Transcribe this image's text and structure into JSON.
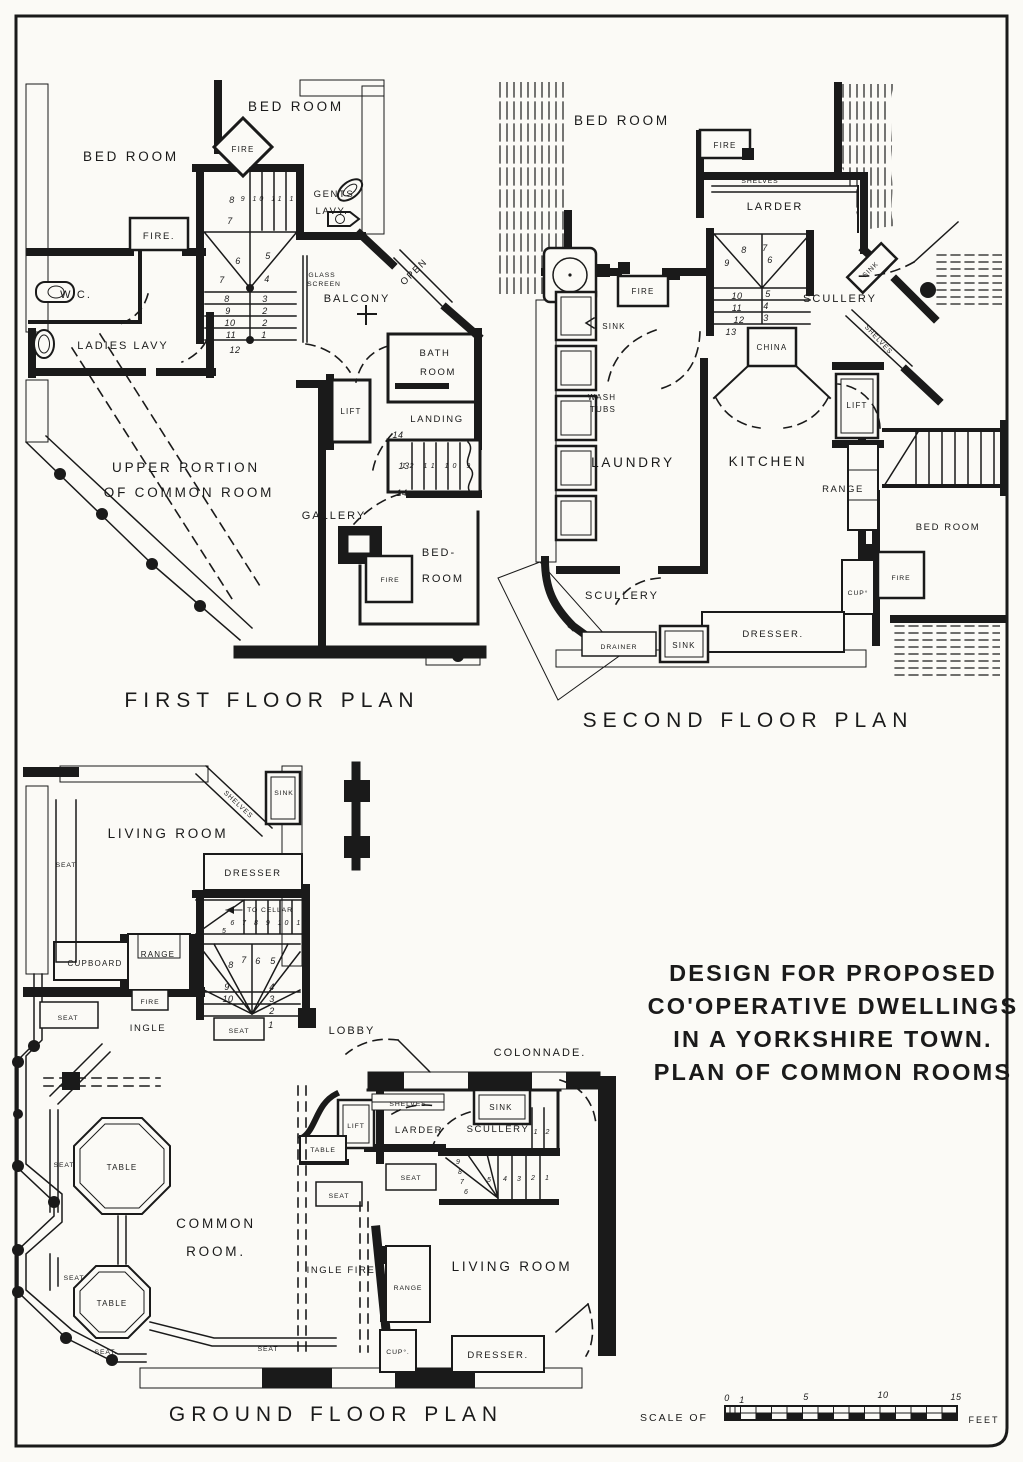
{
  "sheet": {
    "background": "#fbfaf6",
    "ink": "#1a1a1a"
  },
  "title_block": {
    "l1": "DESIGN FOR PROPOSED",
    "l2": "CO'OPERATIVE DWELLINGS",
    "l3": "IN A YORKSHIRE TOWN.",
    "l4": "PLAN OF COMMON ROOMS"
  },
  "scale_bar": {
    "prefix": "SCALE OF",
    "suffix": "FEET",
    "t0": "0",
    "t1": "1",
    "t5": "5",
    "t10": "10",
    "t15": "15"
  },
  "first_floor": {
    "caption": "FIRST FLOOR PLAN",
    "labels": {
      "bed_room_top": "BED ROOM",
      "bed_room_left": "BED ROOM",
      "fire_diamond": "FIRE",
      "gents_1": "GENTS",
      "gents_2": "LAVY.",
      "fire_left": "FIRE.",
      "wc": "W.C.",
      "ladies_lavy": "LADIES LAVY",
      "balcony": "BALCONY",
      "open": "OPEN",
      "glass_1": "GLASS",
      "glass_2": "SCREEN",
      "bath_1": "BATH",
      "bath_2": "ROOM",
      "lift": "LIFT",
      "landing": "LANDING",
      "gallery": "GALLERY",
      "upper_1": "UPPER PORTION",
      "upper_2": "OF COMMON ROOM",
      "bed_1": "BED-",
      "bed_2": "ROOM",
      "fire_small": "FIRE"
    },
    "numbers": {
      "n8": "8",
      "run_up": "9 10 11 12",
      "n7a": "7",
      "n6": "6",
      "n5": "5",
      "n7b": "7",
      "n4": "4",
      "r8": "8",
      "r3": "3",
      "r9": "9",
      "r2a": "2",
      "r10": "10",
      "r2b": "2",
      "r11": "11",
      "r1": "1",
      "r12": "12",
      "l14a": "14",
      "l13": "13",
      "l_run": "12 11 10 9",
      "l14b": "14"
    }
  },
  "second_floor": {
    "caption": "SECOND FLOOR PLAN",
    "labels": {
      "bed_room": "BED ROOM",
      "fire_top": "FIRE",
      "shelves": "SHELVES",
      "larder": "LARDER",
      "scullery_top": "SCULLERY",
      "sink_diag": "SINK",
      "shelves_diag": "SHELVES",
      "china": "CHINA",
      "fire_mid": "FIRE",
      "sink_left": "SINK",
      "wash_1": "WASH",
      "wash_2": "TUBS",
      "laundry": "LAUNDRY",
      "kitchen": "KITCHEN",
      "range": "RANGE",
      "lift": "LIFT",
      "bed_room_right": "BED ROOM",
      "fire_right": "FIRE",
      "cup": "CUP°",
      "scullery_bottom": "SCULLERY",
      "drainer": "DRAINER",
      "sink_bottom": "SINK",
      "dresser": "DRESSER."
    },
    "numbers": {
      "s8": "8",
      "s7": "7",
      "s9": "9",
      "s6": "6",
      "s10": "10",
      "s5": "5",
      "s11": "11",
      "s4": "4",
      "s12": "12",
      "s3": "3",
      "s13": "13"
    }
  },
  "ground_floor": {
    "caption": "GROUND FLOOR PLAN",
    "labels": {
      "living_room_top": "LIVING ROOM",
      "sink_top": "SINK",
      "shelves_top": "SHELVES",
      "dresser_top": "DRESSER",
      "to_cellar": "TO CELLAR",
      "cupboard": "CUPBOARD",
      "range_top": "RANGE",
      "fire": "FIRE",
      "ingle": "INGLE",
      "lobby": "LOBBY",
      "colonnade": "COLONNADE.",
      "shelves_mid": "SHELVES",
      "sink_mid": "SINK",
      "larder": "LARDER",
      "scullery": "SCULLERY",
      "lift": "LIFT",
      "table_lift": "TABLE",
      "common_1": "COMMON",
      "common_2": "ROOM.",
      "table_1": "TABLE",
      "table_2": "TABLE",
      "ingle_fire": "INGLE FIRE",
      "range_bottom": "RANGE",
      "living_room_bottom": "LIVING ROOM",
      "cup": "CUP°.",
      "dresser_bottom": "DRESSER.",
      "seat_window": "SEAT",
      "seat_ingle_left": "SEAT",
      "seat_stair": "SEAT",
      "seat_bay_upper": "SEAT",
      "seat_bay_lower": "SEAT",
      "seat_bay_corner": "SEAT.",
      "seat_bottom": "SEAT",
      "seat_ingle_right": "SEAT",
      "seat_living": "SEAT"
    },
    "numbers": {
      "cellar_run": "6 7 8 9 10 11",
      "cellar_5": "5",
      "f8": "8",
      "f7": "7",
      "f6": "6",
      "f5": "5",
      "r9": "9",
      "r4": "4",
      "r10": "10",
      "r3": "3",
      "r2": "2",
      "r1": "1",
      "c9": "9",
      "c8": "8",
      "c7": "7",
      "c6": "6",
      "t5": "5",
      "t4": "4",
      "t3": "3",
      "t2": "2",
      "t1": "1",
      "steps": "1 2"
    }
  }
}
